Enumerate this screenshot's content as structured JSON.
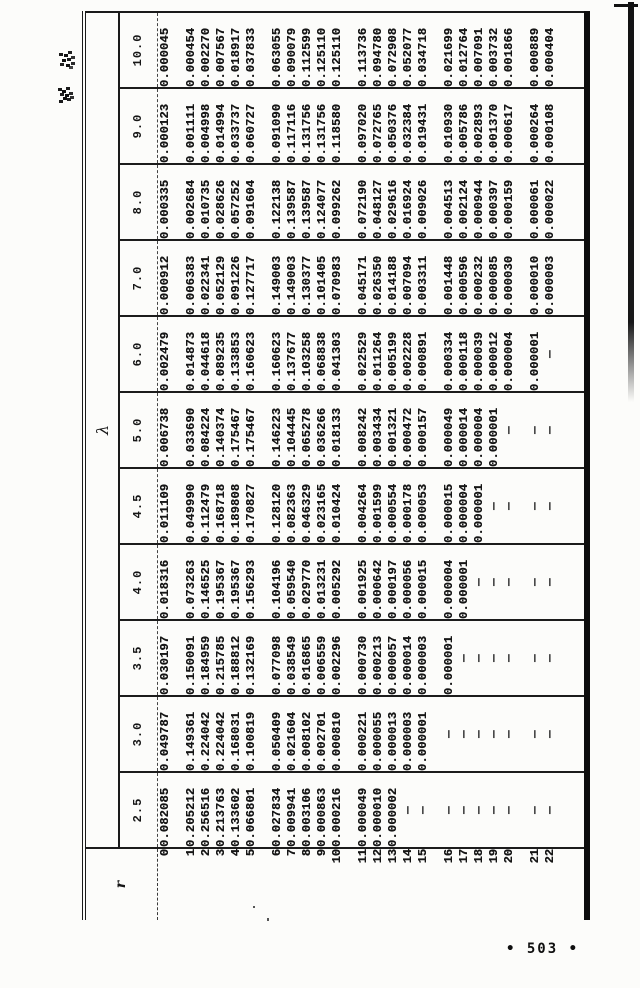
{
  "page": {
    "continued_label": "续表",
    "page_number": "• 503 •"
  },
  "table": {
    "corner_label": "r",
    "lambda_label": "λ",
    "dash": "—",
    "r_values": [
      "0",
      "1",
      "2",
      "3",
      "4",
      "5",
      "6",
      "7",
      "8",
      "9",
      "10",
      "11",
      "12",
      "13",
      "14",
      "15",
      "16",
      "17",
      "18",
      "19",
      "20",
      "21",
      "22"
    ],
    "columns": [
      {
        "lambda": "2.5",
        "values": [
          "0.082085",
          "0.205212",
          "0.256516",
          "0.213763",
          "0.133602",
          "0.066801",
          "0.027834",
          "0.009941",
          "0.003106",
          "0.000863",
          "0.000216",
          "0.000049",
          "0.000010",
          "0.000002",
          "—",
          "—",
          "—",
          "—",
          "—",
          "—",
          "—",
          "—",
          "—"
        ]
      },
      {
        "lambda": "3.0",
        "values": [
          "0.049787",
          "0.149361",
          "0.224042",
          "0.224042",
          "0.168031",
          "0.100819",
          "0.050409",
          "0.021604",
          "0.008102",
          "0.002701",
          "0.000810",
          "0.000221",
          "0.000055",
          "0.000013",
          "0.000003",
          "0.000001",
          "—",
          "—",
          "—",
          "—",
          "—",
          "—",
          "—"
        ]
      },
      {
        "lambda": "3.5",
        "values": [
          "0.030197",
          "0.150091",
          "0.184959",
          "0.215785",
          "0.188812",
          "0.132169",
          "0.077098",
          "0.038549",
          "0.016865",
          "0.006559",
          "0.002296",
          "0.000730",
          "0.000213",
          "0.000057",
          "0.000014",
          "0.000003",
          "0.000001",
          "—",
          "—",
          "—",
          "—",
          "—",
          "—"
        ]
      },
      {
        "lambda": "4.0",
        "values": [
          "0.018316",
          "0.073263",
          "0.146525",
          "0.195367",
          "0.195367",
          "0.156293",
          "0.104196",
          "0.059540",
          "0.029770",
          "0.013231",
          "0.005292",
          "0.001925",
          "0.000642",
          "0.000197",
          "0.000056",
          "0.000015",
          "0.000004",
          "0.000001",
          "—",
          "—",
          "—",
          "—",
          "—"
        ]
      },
      {
        "lambda": "4.5",
        "values": [
          "0.011109",
          "0.049990",
          "0.112479",
          "0.168718",
          "0.189808",
          "0.170827",
          "0.128120",
          "0.082363",
          "0.046329",
          "0.023165",
          "0.010424",
          "0.004264",
          "0.001599",
          "0.000554",
          "0.000178",
          "0.000053",
          "0.000015",
          "0.000004",
          "0.000001",
          "—",
          "—",
          "—",
          "—"
        ]
      },
      {
        "lambda": "5.0",
        "values": [
          "0.006738",
          "0.033690",
          "0.084224",
          "0.140374",
          "0.175467",
          "0.175467",
          "0.146223",
          "0.104445",
          "0.065278",
          "0.036266",
          "0.018133",
          "0.008242",
          "0.003434",
          "0.001321",
          "0.000472",
          "0.000157",
          "0.000049",
          "0.000014",
          "0.000004",
          "0.000001",
          "—",
          "—",
          "—"
        ]
      },
      {
        "lambda": "6.0",
        "values": [
          "0.002479",
          "0.014873",
          "0.044618",
          "0.089235",
          "0.133853",
          "0.160623",
          "0.160623",
          "0.137677",
          "0.103258",
          "0.068838",
          "0.041303",
          "0.022529",
          "0.011264",
          "0.005199",
          "0.002228",
          "0.000891",
          "0.000334",
          "0.000118",
          "0.000039",
          "0.000012",
          "0.000004",
          "0.000001",
          "—"
        ]
      },
      {
        "lambda": "7.0",
        "values": [
          "0.000912",
          "0.006383",
          "0.022341",
          "0.052129",
          "0.091226",
          "0.127717",
          "0.149003",
          "0.149003",
          "0.130377",
          "0.101405",
          "0.070983",
          "0.045171",
          "0.026350",
          "0.014188",
          "0.007094",
          "0.003311",
          "0.001448",
          "0.000596",
          "0.000232",
          "0.000085",
          "0.000030",
          "0.000010",
          "0.000003"
        ]
      },
      {
        "lambda": "8.0",
        "values": [
          "0.000335",
          "0.002684",
          "0.010735",
          "0.028626",
          "0.057252",
          "0.091604",
          "0.122138",
          "0.139587",
          "0.139587",
          "0.124077",
          "0.099262",
          "0.072190",
          "0.048127",
          "0.029616",
          "0.016924",
          "0.009026",
          "0.004513",
          "0.002124",
          "0.000944",
          "0.000397",
          "0.000159",
          "0.000061",
          "0.000022"
        ]
      },
      {
        "lambda": "9.0",
        "values": [
          "0.000123",
          "0.001111",
          "0.004998",
          "0.014994",
          "0.033737",
          "0.060727",
          "0.091090",
          "0.117116",
          "0.131756",
          "0.131756",
          "0.118580",
          "0.097020",
          "0.072765",
          "0.050376",
          "0.032384",
          "0.019431",
          "0.010930",
          "0.005786",
          "0.002893",
          "0.001370",
          "0.000617",
          "0.000264",
          "0.000108"
        ]
      },
      {
        "lambda": "10.0",
        "values": [
          "0.000045",
          "0.000454",
          "0.002270",
          "0.007567",
          "0.018917",
          "0.037833",
          "0.063055",
          "0.090079",
          "0.112599",
          "0.125110",
          "0.125110",
          "0.113736",
          "0.094780",
          "0.072908",
          "0.052077",
          "0.034718",
          "0.021699",
          "0.012764",
          "0.007091",
          "0.003732",
          "0.001866",
          "0.000889",
          "0.000404"
        ]
      }
    ]
  }
}
